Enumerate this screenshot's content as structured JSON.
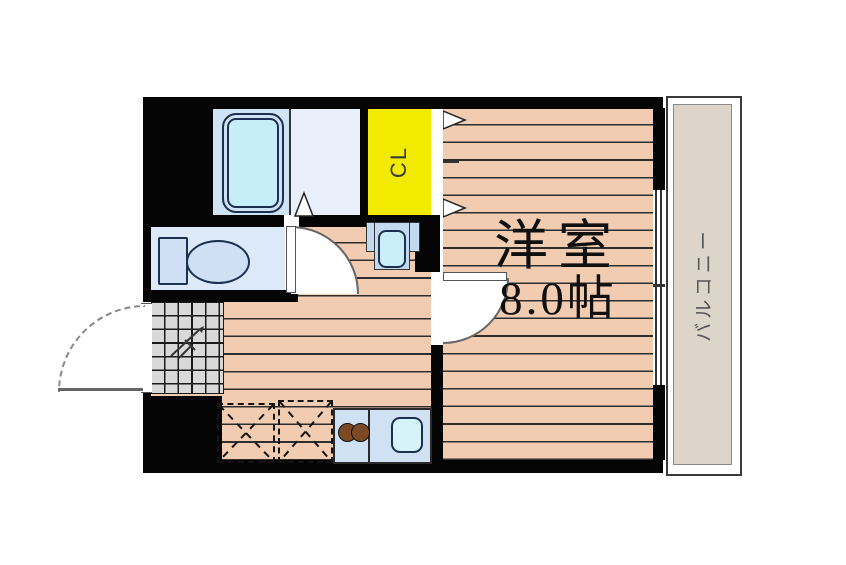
{
  "floorplan": {
    "room": {
      "name": "洋室",
      "size": "8.0帖"
    },
    "closet": {
      "label": "CL"
    },
    "balcony": {
      "label": "バルコニー"
    },
    "icons": [
      "bathtub-icon",
      "bath-door-triangle-icon",
      "toilet-icon",
      "washbasin-icon",
      "closet-door-triangles-icon",
      "room-door-arc-icon",
      "washroom-door-arc-icon",
      "entrance-door-arc-icon",
      "entrance-tiles-icon",
      "appliance-space-box-icon",
      "stove-burners-icon",
      "kitchen-sink-icon",
      "sliding-window-icon"
    ],
    "colors": {
      "wall": "#050505",
      "wood_floor": "#f1ccb0",
      "plank_line": "#2e2e2e",
      "closet_yellow": "#f2ea00",
      "bathroom_blue": "#cfe3f4",
      "washroom_blue": "#e9f0fb",
      "toilet_room_blue": "#dce9f8",
      "bathtub_fill": "#c6eef8",
      "fixture_outline": "#1c3050",
      "balcony_fill": "#ded5ca",
      "entrance_tile_gray": "#d9d9d9",
      "burner_brown": "#7b4a25",
      "sink_fill": "#d6f3f9",
      "kitchen_counter": "#cfe1f3"
    }
  }
}
